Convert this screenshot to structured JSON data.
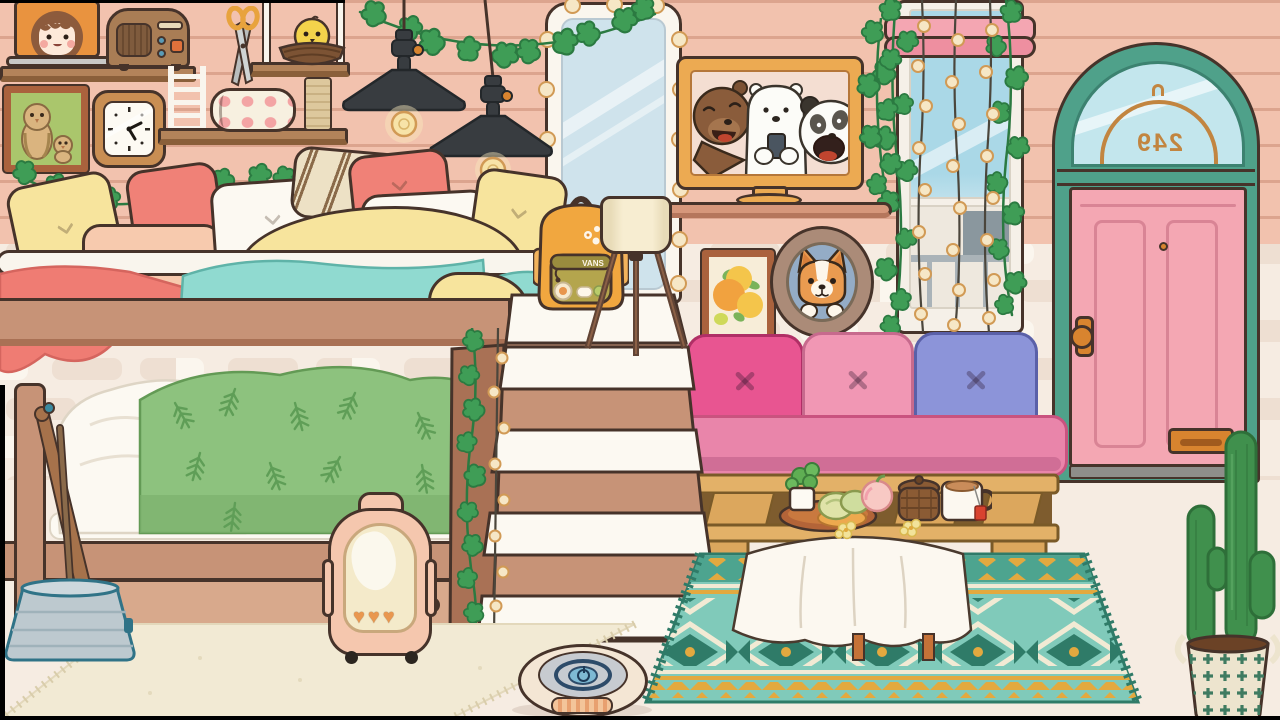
{
  "scene": {
    "name": "toca-style-cozy-bedroom",
    "door_number": "249",
    "backpack_brand": "VANS"
  },
  "icons": {
    "heart": "♥"
  },
  "inventory": [
    "laptop",
    "radio",
    "scissors",
    "bird-nest",
    "cat-tree",
    "pencil-case",
    "wall-clock",
    "owl-picture",
    "pendant-lamps",
    "vanity-mirror",
    "bears-tv",
    "orange-painting",
    "corgi-porthole",
    "window-string-lights",
    "door-249",
    "bunk-bed",
    "stairs",
    "vans-backpack",
    "tripod-lamp",
    "pallet-sofa",
    "coffee-table",
    "teal-rug",
    "cream-rug",
    "bucket-brooms",
    "pet-carrier",
    "robot-vacuum",
    "cactus",
    "ivy-vines"
  ],
  "colors": {
    "wall": "#f6ece2",
    "brick": "#eedfd2",
    "brick-light": "#fbf6ee",
    "floor": "#f2c2ae",
    "floor-line": "#dca48e",
    "outline": "#46332a",
    "wood": "#c79377",
    "wood-light": "#d8a98c",
    "wood-dark": "#a97155",
    "shelf": "#b3835a",
    "shelf-edge": "#8a5f3a",
    "door-teal": "#4fa18a",
    "door-teal-dark": "#3c8270",
    "door-pink": "#f4a7b3",
    "door-panel-line": "#d98495",
    "door-glass": "#c3e6ed",
    "gold": "#c28540",
    "knob": "#d8842f",
    "ivy": "#3f9d56",
    "ivy-dark": "#2b7a41",
    "lamp-black": "#383c40",
    "glow": "#f9e9bd",
    "bulb": "#f6e7c6",
    "bulb-ring": "#d19a55",
    "mirror-frame": "#faf6ee",
    "mirror-glass": "#cfe3ec",
    "tv-frame": "#ecaa52",
    "tv-bg": "#f4ded2",
    "shelf-pink": "#d6977b",
    "frame-brown": "#aa623d",
    "canvas": "#f7edd8",
    "orange-fruit": "#f1a23f",
    "orange-light": "#f4c54b",
    "leaf-green": "#7ab35a",
    "porthole": "#ab8b78",
    "porthole-blue": "#94acc6",
    "corgi": "#ea9b50",
    "window-frame": "#f5f0e8",
    "valance": "#f4a6b2",
    "valance-dark": "#ee8fa0",
    "sky": "#aad8e7",
    "cord": "#4b463c",
    "pillow-yellow": "#f7e49d",
    "pillow-peach": "#f7caae",
    "pillow-white": "#fcf9f2",
    "pillow-coral": "#f08177",
    "stripe-cream": "#ede1c5",
    "stripe-brown": "#8a6a49",
    "blanket-red": "#ef7c73",
    "blanket-teal": "#90dad0",
    "blanket-green": "#8dc27e",
    "fern": "#5f9e57",
    "sofa-pink": "#e985aa",
    "sofa-border": "#c9537f",
    "cushion-magenta": "#e85591",
    "cushion-rose": "#f197b4",
    "cushion-blue": "#8c94d9",
    "pallet": "#dca75d",
    "pallet-dark": "#7e5c2e",
    "pallet-light": "#e3b168",
    "rug-teal": "#80caba",
    "rug-dark": "#2f7b68",
    "rug-mid": "#4da48f",
    "rug-cream": "#f2ead4",
    "rug-gold": "#e3a93f",
    "cloth": "#fcf8f0",
    "tray": "#b36438",
    "basket": "#8b5b34",
    "tea-red": "#d9432f",
    "carrier": "#f5c7ae",
    "carrier-window": "#f4eaca",
    "heart-orange": "#e9974f",
    "roomba-body": "#f4e6d4",
    "roomba-top": "#c7cbd0",
    "roomba-ring": "#2d4b69",
    "roomba-btn": "#7eb9d3",
    "bucket": "#bdc9cf",
    "bucket-dark": "#307387",
    "stick": "#a6724b",
    "cactus": "#40904d",
    "cactus-dark": "#2e6f39",
    "pot": "#ede4ce",
    "pot-green": "#3f7b61",
    "backpack": "#f1a73f",
    "backpack-olive": "#b4a54d",
    "shade": "#f7edd1",
    "leg": "#8b6046",
    "step": "#fcf9f2",
    "rail": "#f9f5ed",
    "radio": "#a97d55",
    "radio-dark": "#7f5b3d",
    "radio-knob": "#5a9bb6",
    "radio-btn": "#e0713b",
    "clock-frame": "#c98e53",
    "pic-green": "#aac66c",
    "owl": "#dab47f",
    "laptop": "#c8c8c6",
    "laptop-screen": "#e9933f",
    "girl-hair": "#8d5b3c",
    "girl-skin": "#fde9d9",
    "nest": "#7c5334",
    "chick": "#f3d34b",
    "scratch": "#ddc89d",
    "pencil-case": "#f7f0e0",
    "peach-dot": "#f3a4a4"
  }
}
